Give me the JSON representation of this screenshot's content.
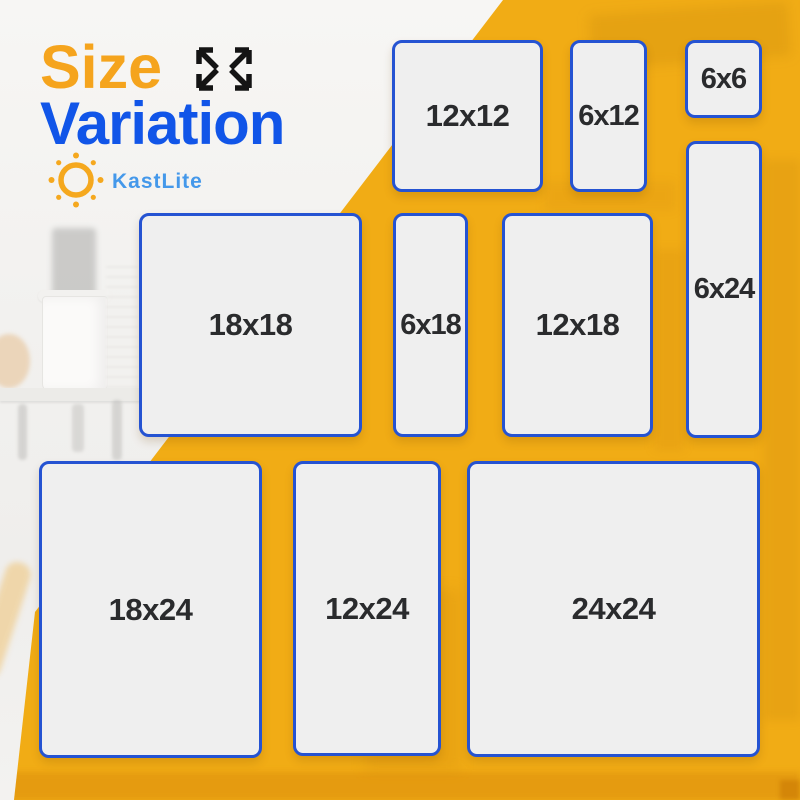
{
  "title": {
    "line1": "Size",
    "line2": "Variation"
  },
  "brand": {
    "name": "KastLite",
    "logo_icon": "sun-icon"
  },
  "header_icon": "expand-arrows-icon",
  "sizes": [
    {
      "label": "12x12"
    },
    {
      "label": "6x12"
    },
    {
      "label": "6x6"
    },
    {
      "label": "6x24"
    },
    {
      "label": "18x18"
    },
    {
      "label": "6x18"
    },
    {
      "label": "12x18"
    },
    {
      "label": "18x24"
    },
    {
      "label": "12x24"
    },
    {
      "label": "24x24"
    }
  ],
  "colors": {
    "yellow": "#F1AC15",
    "title_orange": "#F5A41D",
    "title_blue": "#1155E8",
    "border_blue": "#2553D2",
    "brand_blue": "#4498EA",
    "box_fill": "#EFEFEF",
    "label_dark": "#2A2B2D"
  }
}
